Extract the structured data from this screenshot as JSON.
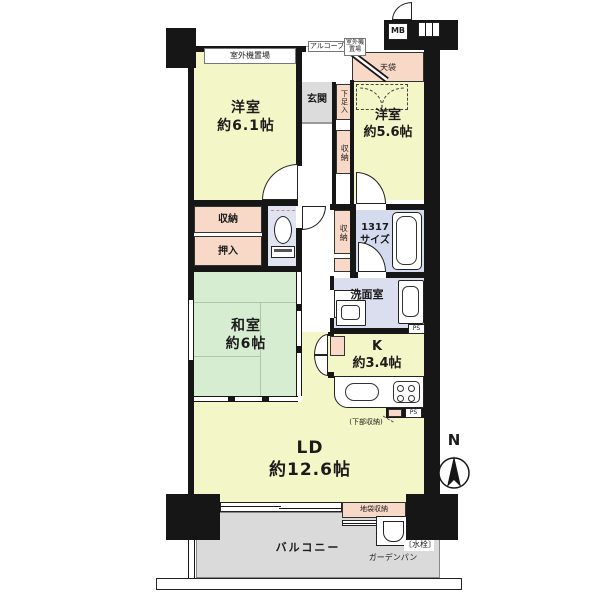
{
  "rooms": {
    "yoshitsu1": {
      "name": "洋室",
      "size": "約6.1帖"
    },
    "yoshitsu2": {
      "name": "洋室",
      "size": "約5.6帖"
    },
    "washitsu": {
      "name": "和室",
      "size": "約6帖"
    },
    "ld": {
      "name": "LD",
      "size": "約12.6帖"
    },
    "kitchen": {
      "name": "K",
      "size": "約3.4帖"
    },
    "bath": {
      "line1": "1317",
      "line2": "サイズ"
    },
    "senmen": {
      "name": "洗面室"
    },
    "genkan": {
      "name": "玄関"
    },
    "balcony": {
      "name": "バルコニー"
    }
  },
  "storage": {
    "closet": "収納",
    "oshiire": "押入",
    "shoe": "下足入",
    "hall_upper": "収納",
    "bath_side": "収納",
    "tenbukuro": "天袋",
    "jibukuro": "地袋収納",
    "under_counter": "(下部収納)"
  },
  "exterior": {
    "outdoor_unit": "室外機置場",
    "outdoor_unit_small": "室外機置場",
    "alcove": "アルコーブ",
    "mb": "MB",
    "gardenpan": "ガーデンパン",
    "suisen": "〔水栓〕"
  },
  "misc": {
    "ps": "PS",
    "north": "N"
  },
  "colors": {
    "wall": "#161616",
    "western_room": "#f3f6c6",
    "tatami_room": "#d7edd2",
    "storage_pink": "#f8d8c6",
    "wet_area_blue": "#d5dbee",
    "balcony_gray": "#dadada"
  }
}
